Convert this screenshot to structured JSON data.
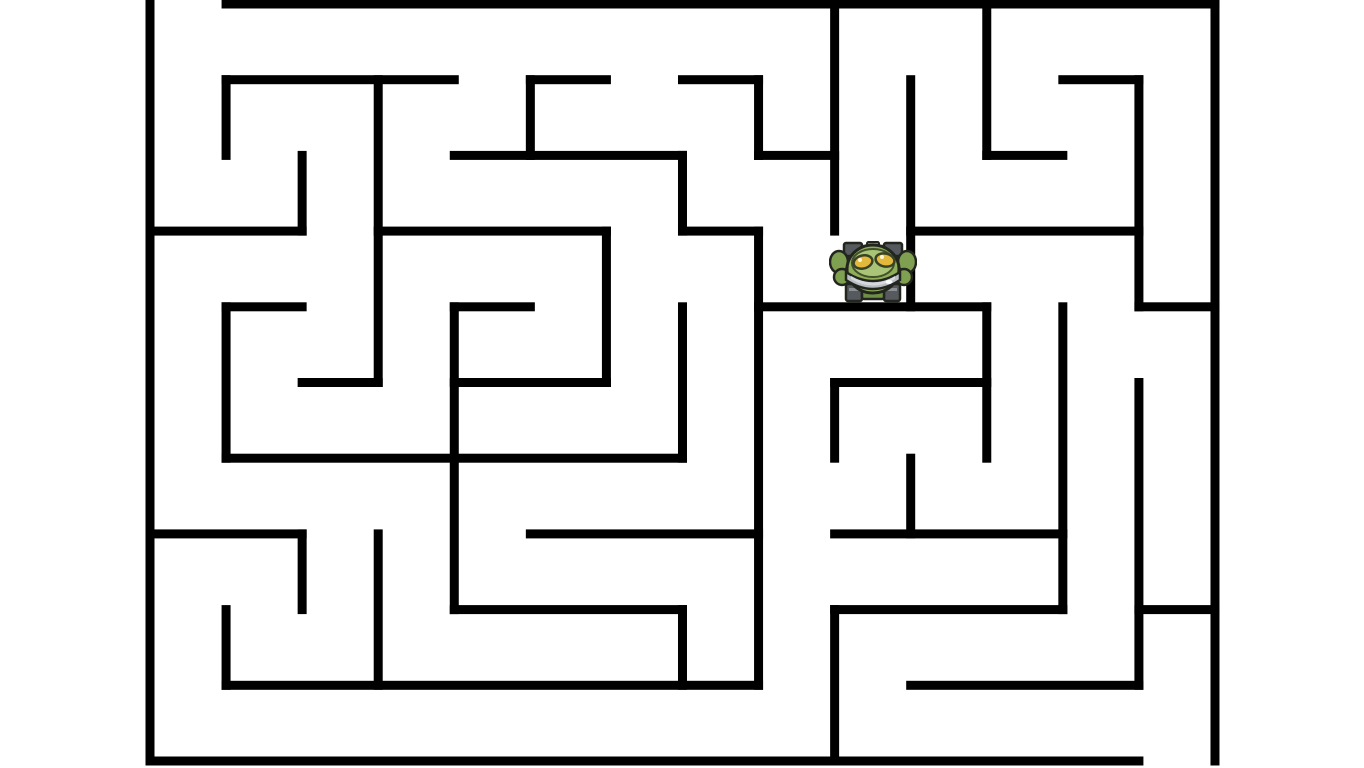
{
  "app": {
    "type": "maze-game",
    "background_color": "#ffffff"
  },
  "maze": {
    "geometry": {
      "origin_x": 150,
      "origin_y": 4,
      "cols": 14,
      "rows": 10,
      "cell_w": 76.07,
      "cell_h": 75.7,
      "wall_thickness": 9,
      "wall_color": "#000000"
    },
    "entrance_gap": {
      "edge": "top",
      "col": 0
    },
    "exit_gap": {
      "edge": "bottom",
      "col": 13
    },
    "h_walls": [
      [
        0,
        1,
        14
      ],
      [
        1,
        1,
        4
      ],
      [
        1,
        5,
        6
      ],
      [
        1,
        7,
        8
      ],
      [
        1,
        12,
        13
      ],
      [
        2,
        4,
        7
      ],
      [
        2,
        8,
        9
      ],
      [
        2,
        11,
        12
      ],
      [
        3,
        0,
        2
      ],
      [
        3,
        3,
        6
      ],
      [
        3,
        7,
        8
      ],
      [
        3,
        10,
        13
      ],
      [
        4,
        1,
        2
      ],
      [
        4,
        4,
        5
      ],
      [
        4,
        8,
        11
      ],
      [
        4,
        13,
        14
      ],
      [
        5,
        2,
        3
      ],
      [
        5,
        4,
        6
      ],
      [
        5,
        9,
        11
      ],
      [
        6,
        1,
        7
      ],
      [
        7,
        0,
        2
      ],
      [
        7,
        5,
        8
      ],
      [
        7,
        9,
        12
      ],
      [
        8,
        4,
        7
      ],
      [
        8,
        9,
        12
      ],
      [
        8,
        13,
        14
      ],
      [
        9,
        1,
        8
      ],
      [
        9,
        10,
        13
      ],
      [
        10,
        0,
        13
      ]
    ],
    "v_walls": [
      [
        0,
        0,
        10
      ],
      [
        1,
        1,
        2
      ],
      [
        1,
        4,
        6
      ],
      [
        1,
        8,
        9
      ],
      [
        2,
        2,
        3
      ],
      [
        2,
        7,
        8
      ],
      [
        3,
        1,
        5
      ],
      [
        3,
        7,
        9
      ],
      [
        4,
        4,
        8
      ],
      [
        5,
        1,
        2
      ],
      [
        6,
        3,
        5
      ],
      [
        7,
        2,
        3
      ],
      [
        7,
        4,
        6
      ],
      [
        7,
        8,
        9
      ],
      [
        8,
        1,
        2
      ],
      [
        8,
        3,
        9
      ],
      [
        9,
        0,
        3
      ],
      [
        9,
        5,
        6
      ],
      [
        9,
        8,
        10
      ],
      [
        10,
        1,
        4
      ],
      [
        10,
        6,
        7
      ],
      [
        11,
        0,
        2
      ],
      [
        11,
        4,
        6
      ],
      [
        12,
        4,
        8
      ],
      [
        13,
        1,
        4
      ],
      [
        13,
        5,
        9
      ],
      [
        14,
        0,
        10
      ]
    ]
  },
  "player": {
    "cell": {
      "col": 9,
      "row": 3
    },
    "x": 829,
    "y": 241,
    "width": 88,
    "height": 63,
    "colors": {
      "outline": "#23261e",
      "dome": "#8fae58",
      "dome_top": "#a9c477",
      "rim": "#b9bec4",
      "rim_light": "#d7dadd",
      "eye": "#e3b93c",
      "claw": "#7fa051",
      "chassis": "#565a5e",
      "chassis_light": "#8b9094",
      "belly": "#6f8f47"
    }
  }
}
